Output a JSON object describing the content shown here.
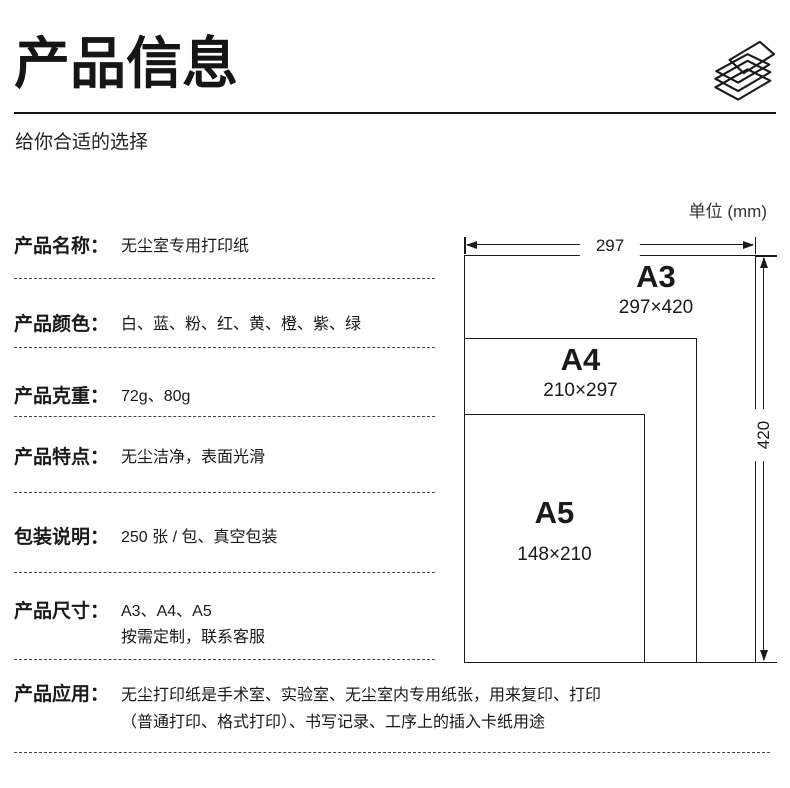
{
  "header": {
    "title": "产品信息",
    "subtitle": "给你合适的选择"
  },
  "specs": [
    {
      "label": "产品名称：",
      "value": "无尘室专用打印纸"
    },
    {
      "label": "产品颜色：",
      "value": "白、蓝、粉、红、黄、橙、紫、绿"
    },
    {
      "label": "产品克重：",
      "value": "72g、80g"
    },
    {
      "label": "产品特点：",
      "value": "无尘洁净，表面光滑"
    },
    {
      "label": "包装说明：",
      "value": "250 张 / 包、真空包装"
    },
    {
      "label": "产品尺寸：",
      "value": "A3、A4、A5",
      "value2": "按需定制，联系客服"
    },
    {
      "label": "产品应用：",
      "value": "无尘打印纸是手术室、实验室、无尘室内专用纸张，用来复印、打印",
      "value2": "（普通打印、格式打印）、书写记录、工序上的插入卡纸用途"
    }
  ],
  "diagram": {
    "unit_label": "单位 (mm)",
    "width_dim": "297",
    "height_dim": "420",
    "sizes": [
      {
        "name": "A3",
        "dims": "297×420"
      },
      {
        "name": "A4",
        "dims": "210×297"
      },
      {
        "name": "A5",
        "dims": "148×210"
      }
    ]
  },
  "colors": {
    "ink": "#1a1a1a",
    "background": "#ffffff"
  }
}
